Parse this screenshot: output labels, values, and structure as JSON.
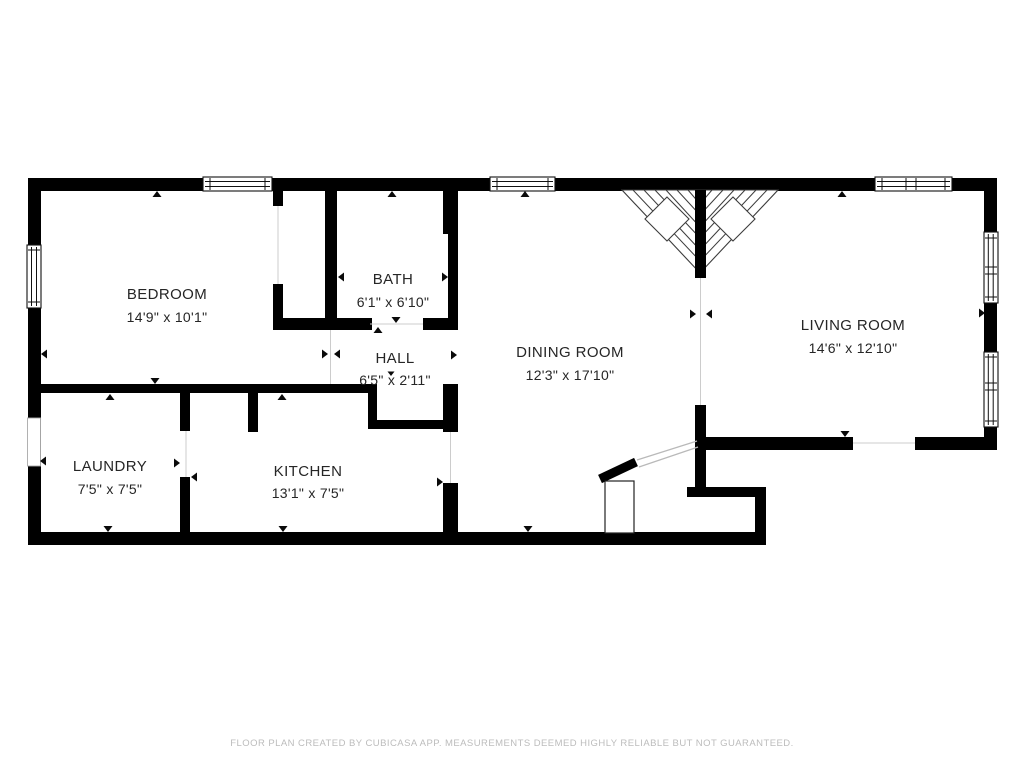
{
  "colors": {
    "wall": "#000000",
    "label": "#262626",
    "muted": "#bcbcbc"
  },
  "rooms": [
    {
      "id": "bedroom",
      "name": "BEDROOM",
      "dims": "14'9\" x 10'1\""
    },
    {
      "id": "bath",
      "name": "BATH",
      "dims": "6'1\" x 6'10\""
    },
    {
      "id": "hall",
      "name": "HALL",
      "dims": "6'5\" x 2'11\""
    },
    {
      "id": "dining-room",
      "name": "DINING ROOM",
      "dims": "12'3\" x 17'10\""
    },
    {
      "id": "living-room",
      "name": "LIVING ROOM",
      "dims": "14'6\" x 12'10\""
    },
    {
      "id": "laundry",
      "name": "LAUNDRY",
      "dims": "7'5\" x 7'5\""
    },
    {
      "id": "kitchen",
      "name": "KITCHEN",
      "dims": "13'1\" x 7'5\""
    }
  ],
  "footer": {
    "disclaimer": "FLOOR PLAN CREATED BY CUBICASA APP. MEASUREMENTS DEEMED HIGHLY RELIABLE BUT NOT GUARANTEED."
  }
}
